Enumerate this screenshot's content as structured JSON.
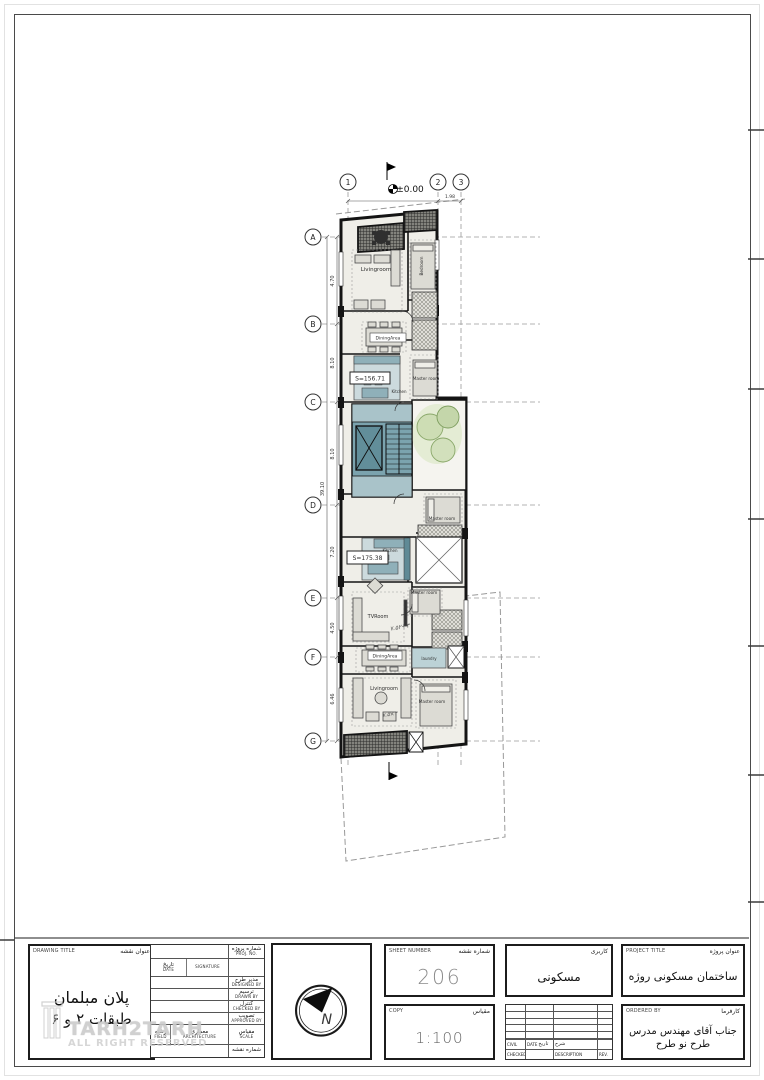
{
  "sheet": {
    "watermark_line1": "TARH2TARH",
    "watermark_line2": "ALL RIGHT RESERVED"
  },
  "plan": {
    "grid_columns": [
      "1",
      "2",
      "3"
    ],
    "grid_rows": [
      "A",
      "B",
      "C",
      "D",
      "E",
      "F",
      "G"
    ],
    "level_zero": "±0.00",
    "dim_top": "1.98",
    "dims_left": [
      "4.70",
      "8.10",
      "8.10",
      "7.20",
      "4.50",
      "6.46"
    ],
    "dim_overall": "39.10",
    "labels": {
      "livingroom_1": "Livingroom",
      "bedroom_1": "Bedroom",
      "dining_1": "DiningArea",
      "area_1": "S=156.71",
      "kitchen_1": "Kitchen",
      "master_1": "Master room",
      "master_2": "Master room",
      "kitchen_2": "Kitchen",
      "area_2": "S=175.38",
      "tvroom": "TVRoom",
      "master_3": "Master room",
      "laundry": "laundry",
      "dining_2": "DiningArea",
      "livingroom_2": "Livingroom",
      "master_4": "Master room"
    },
    "annotations": {
      "a1": "۷.۵۲+۳",
      "a2": "۷.۵×۳"
    }
  },
  "titleblock": {
    "drawing_title": {
      "label_en": "DRAWING TITLE",
      "label_fa": "عنوان نقشه",
      "line1": "پلان مبلمان",
      "line2": "طبقات ۲ و ۶"
    },
    "info": {
      "proj_no": {
        "fa": "شماره پروژه",
        "en": "PROJ. NO."
      },
      "date": {
        "fa": "تاریخ",
        "en": "DATE"
      },
      "signature": {
        "fa": "امضاء",
        "en": "SIGNATURE"
      },
      "designed": {
        "fa": "مدیر طرح",
        "en": "DESIGNED BY"
      },
      "drawn": {
        "fa": "ترسیم",
        "en": "DRAWN BY"
      },
      "checked": {
        "fa": "کنترل",
        "en": "CHECKED BY"
      },
      "approved": {
        "fa": "تصویب",
        "en": "APPROVED BY"
      },
      "field": {
        "fa": "رشته",
        "en": "FIELD"
      },
      "field_value": {
        "fa": "معماری",
        "en": "ARCHITECTURE"
      },
      "scale": {
        "fa": "مقیاس",
        "en": "SCALE"
      },
      "sheet_no": {
        "fa": "شماره نقشه",
        "en": "NO."
      }
    },
    "north_letter": "N",
    "sheet_number": {
      "label_en": "SHEET NUMBER",
      "label_fa": "شماره نقشه",
      "value": "206"
    },
    "copy": {
      "label_en": "COPY",
      "label_fa": "مقیاس",
      "value": "1:100"
    },
    "usage": {
      "label_fa": "کاربری",
      "value": "مسکونی"
    },
    "project": {
      "label_en": "PROJECT TITLE",
      "label_fa": "عنوان پروژه",
      "value": "ساختمان مسکونی روژه"
    },
    "ordered": {
      "label_en": "ORDERED BY",
      "label_fa": "کارفرما",
      "line1": "جناب آقای مهندس مدرس",
      "line2": "طرح نو طرح"
    },
    "revision": {
      "civil": "CIVIL",
      "civil_fa": "تعهد",
      "date": "DATE",
      "date_fa": "تاریخ",
      "desc_fa": "شرح",
      "checked": "CHECKED",
      "description": "DESCRIPTION",
      "rev": "REV."
    }
  }
}
